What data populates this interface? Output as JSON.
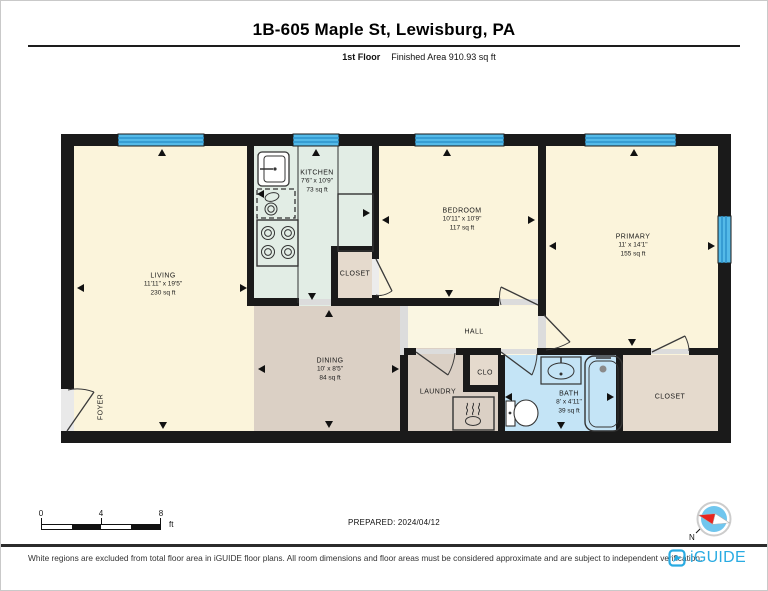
{
  "header": {
    "title": "1B-605 Maple St, Lewisburg, PA",
    "floor_label": "1st Floor",
    "finished_area_label": "Finished Area 910.93 sq ft"
  },
  "rooms": {
    "living": {
      "name": "LIVING",
      "dims": "11'11\" x 19'5\"",
      "area": "230 sq ft"
    },
    "kitchen": {
      "name": "KITCHEN",
      "dims": "7'6\" x 10'9\"",
      "area": "73 sq ft"
    },
    "bedroom": {
      "name": "BEDROOM",
      "dims": "10'11\" x 10'9\"",
      "area": "117 sq ft"
    },
    "primary": {
      "name": "PRIMARY",
      "dims": "11' x 14'1\"",
      "area": "155 sq ft"
    },
    "closet_kitchen": {
      "name": "CLOSET"
    },
    "hall": {
      "name": "HALL"
    },
    "dining": {
      "name": "DINING",
      "dims": "10' x 8'5\"",
      "area": "84 sq ft"
    },
    "laundry": {
      "name": "LAUNDRY"
    },
    "clo": {
      "name": "CLO"
    },
    "bath": {
      "name": "BATH",
      "dims": "8' x 4'11\"",
      "area": "39 sq ft"
    },
    "closet_primary": {
      "name": "CLOSET"
    },
    "foyer": {
      "name": "FOYER"
    }
  },
  "scale_bar": {
    "tick0": "0",
    "tick4": "4",
    "tick8": "8",
    "unit": "ft"
  },
  "prepared_label": "PREPARED: 2024/04/12",
  "compass": {
    "north_label": "N"
  },
  "footer": {
    "disclaimer": "White regions are excluded from total floor area in iGUIDE floor plans. All room dimensions and floor areas must be considered approximate and are subject to independent verification.",
    "brand": "iGUIDE"
  },
  "colors": {
    "accent": "#29ABE2",
    "wall": "#1A1A1A",
    "room_cream": "#FBF4DB",
    "kitchen_mint": "#E2EDE5",
    "tan": "#DBD0C5",
    "closet_tan": "#E5DACD",
    "hall_cream": "#FAF6E2",
    "bath_blue": "#C4E4F6",
    "window_blue": "#54BAE8"
  }
}
